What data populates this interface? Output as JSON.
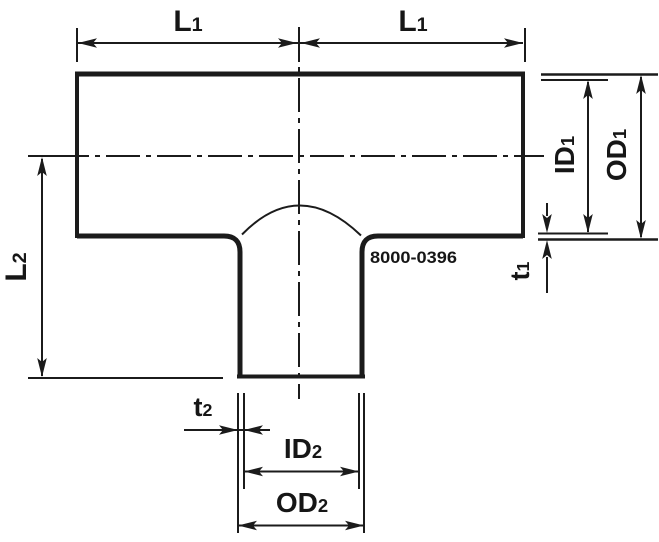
{
  "drawing": {
    "part_number": "8000-0396",
    "colors": {
      "line": "#1b1b1b",
      "background": "#ffffff"
    },
    "labels": {
      "l1_left": {
        "main": "L",
        "sub": "1"
      },
      "l1_right": {
        "main": "L",
        "sub": "1"
      },
      "l2": {
        "main": "L",
        "sub": "2"
      },
      "id1": {
        "main": "ID",
        "sub": "1"
      },
      "od1": {
        "main": "OD",
        "sub": "1"
      },
      "t1": {
        "main": "t",
        "sub": "1"
      },
      "t2": {
        "main": "t",
        "sub": "2"
      },
      "id2": {
        "main": "ID",
        "sub": "2"
      },
      "od2": {
        "main": "OD",
        "sub": "2"
      }
    }
  }
}
